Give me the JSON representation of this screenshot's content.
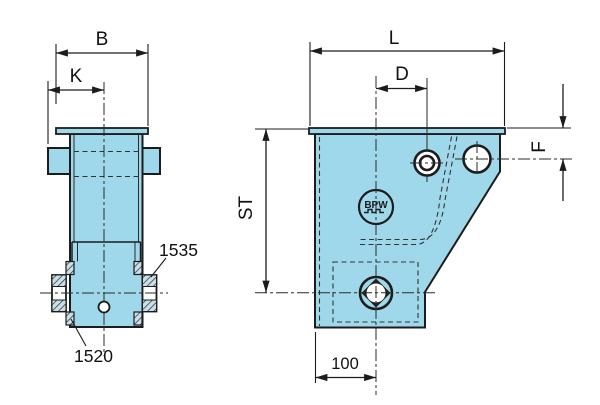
{
  "drawing": {
    "colors": {
      "part_fill": "#9fd8ea",
      "outline": "#1c1c1c",
      "background": "#ffffff"
    },
    "front_view": {
      "dim_b": "B",
      "dim_k": "K",
      "callout_outer_bushing": "1535",
      "callout_inner_bushing": "1520"
    },
    "side_view": {
      "dim_l": "L",
      "dim_d": "D",
      "dim_st": "ST",
      "dim_f": "F",
      "dim_offset": "100",
      "logo": "BPW"
    }
  }
}
